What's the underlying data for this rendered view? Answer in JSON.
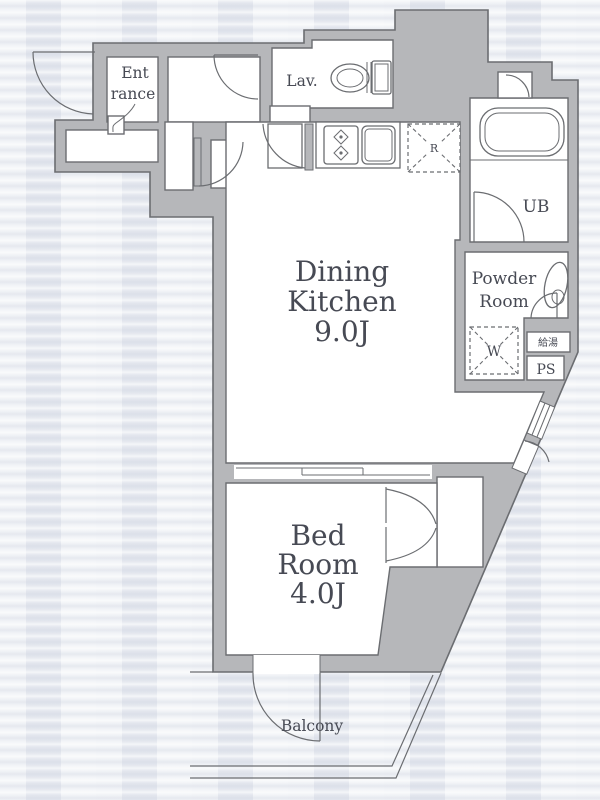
{
  "plan_title": "apartment-floor-plan",
  "colors": {
    "background": "#e8ebf1",
    "wall_fill": "#b6b7ba",
    "wall_line": "#6b6d71",
    "room_fill": "#ffffff",
    "label_text": "#474a54"
  },
  "rooms": {
    "entrance": {
      "lines": [
        "Ent",
        "rance"
      ]
    },
    "lavatory": {
      "label": "Lav."
    },
    "unit_bath": {
      "label": "UB"
    },
    "powder_room": {
      "lines": [
        "Powder",
        "Room"
      ]
    },
    "dining_kitchen": {
      "lines": [
        "Dining",
        "Kitchen",
        "9.0J"
      ]
    },
    "bedroom": {
      "lines": [
        "Bed",
        "Room",
        "4.0J"
      ]
    },
    "balcony": {
      "label": "Balcony"
    }
  },
  "fixtures": {
    "refrigerator": "R",
    "washing_machine": "W",
    "pipe_space": "PS",
    "water_heater": "給湯"
  }
}
